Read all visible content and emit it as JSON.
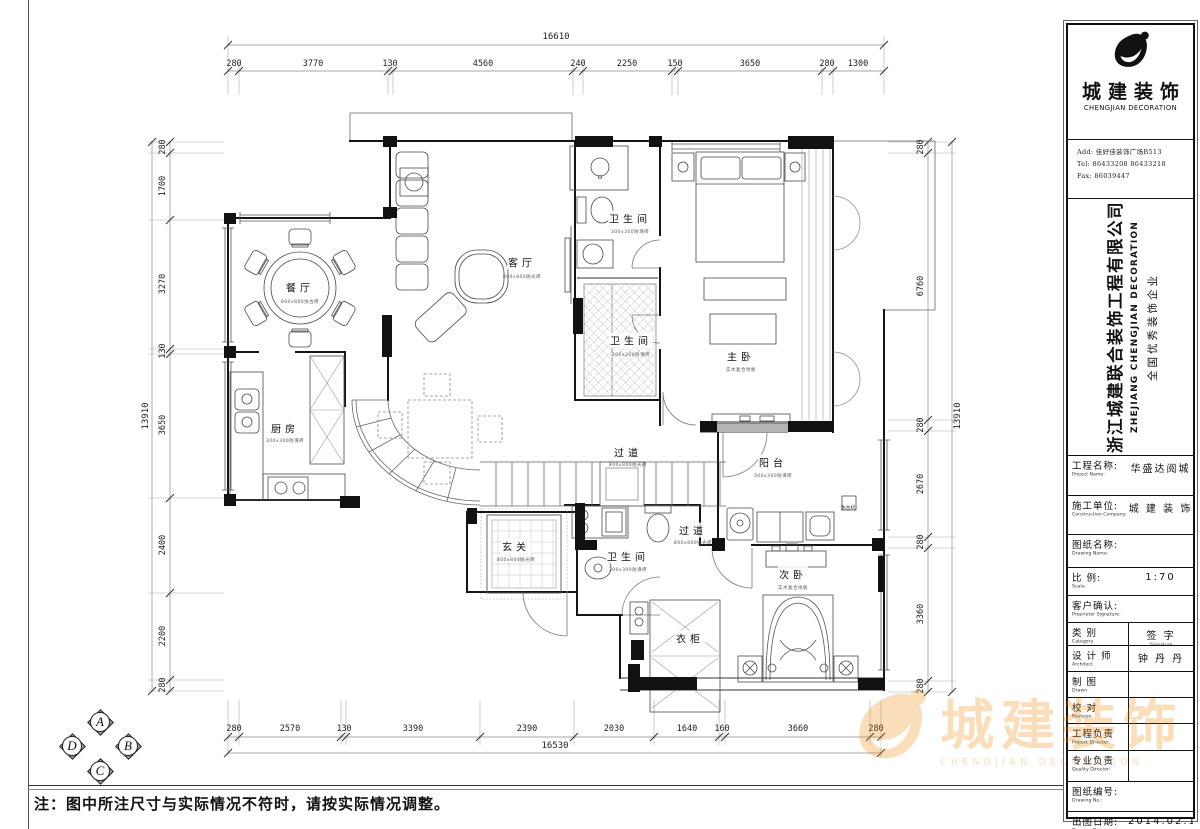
{
  "note": "注：图中所注尺寸与实际情况不符时，请按实际情况调整。",
  "logo": {
    "company_cn": "城建装饰",
    "company_en": "CHENGJIAN DECORATION",
    "address": "Add: 佳好佳装饰广场B513",
    "tel": "Tel: 86433208 86433218",
    "fax": "Fax: 86039447"
  },
  "watermark": {
    "cn": "城建装饰",
    "en": "CHENGJIAN DECORATION"
  },
  "sidebar": {
    "company_full": "浙江城建联合装饰工程有限公司",
    "company_full_en": "ZHEJIANG CHENGJIAN DECORATION",
    "slogan": "全国优秀装饰企业",
    "rows": [
      {
        "label": "工程名称:",
        "sub": "Project Name:",
        "value": "华盛达阅城",
        "h": 39
      },
      {
        "label": "施工单位:",
        "sub": "Construction Company:",
        "value": "城 建 装 饰",
        "h": 38
      },
      {
        "label": "图纸名称:",
        "sub": "Drawing Name:",
        "value": "",
        "h": 32
      },
      {
        "label": "比 例:",
        "sub": "Scale:",
        "value": "1:70",
        "h": 27
      },
      {
        "label": "客户确认:",
        "sub": "Proprietor Signature:",
        "value": "",
        "h": 26
      },
      {
        "label": "类 别",
        "sub": "Category",
        "value": "签 字",
        "vsub": "Signature",
        "h": 22,
        "split": true
      },
      {
        "label": "设 计 师",
        "sub": "Architect",
        "value": "钟 丹 丹",
        "h": 25,
        "split": true
      },
      {
        "label": "制 图",
        "sub": "Drawn",
        "value": "",
        "h": 25,
        "split": true
      },
      {
        "label": "校 对",
        "sub": "Revision",
        "value": "",
        "h": 25,
        "split": true
      },
      {
        "label": "工程负责",
        "sub": "Project Director:",
        "value": "",
        "h": 26,
        "split": true
      },
      {
        "label": "专业负责",
        "sub": "Quality Director:",
        "value": "",
        "h": 30,
        "split": true
      },
      {
        "label": "图纸编号:",
        "sub": "Drawing No.:",
        "value": "",
        "h": 29
      },
      {
        "label": "出图日期:",
        "sub": "Drawing Date:",
        "value": "2014.02.13",
        "h": 26
      }
    ]
  },
  "compass": {
    "items": [
      {
        "t": "A",
        "x": 100,
        "y": 722
      },
      {
        "t": "B",
        "x": 128,
        "y": 746
      },
      {
        "t": "C",
        "x": 100,
        "y": 771
      },
      {
        "t": "D",
        "x": 72,
        "y": 746
      }
    ]
  },
  "plan": {
    "labels": [
      {
        "t": "16610",
        "x": 556,
        "y": 37,
        "cls": "total"
      },
      {
        "t": "280",
        "x": 234,
        "y": 64,
        "cls": "dim"
      },
      {
        "t": "3770",
        "x": 313,
        "y": 64,
        "cls": "dim"
      },
      {
        "t": "130",
        "x": 390,
        "y": 64,
        "cls": "dim"
      },
      {
        "t": "4560",
        "x": 483,
        "y": 64,
        "cls": "dim"
      },
      {
        "t": "240",
        "x": 578,
        "y": 64,
        "cls": "dim"
      },
      {
        "t": "2250",
        "x": 627,
        "y": 64,
        "cls": "dim"
      },
      {
        "t": "150",
        "x": 675,
        "y": 64,
        "cls": "dim"
      },
      {
        "t": "3650",
        "x": 750,
        "y": 64,
        "cls": "dim"
      },
      {
        "t": "280",
        "x": 827,
        "y": 64,
        "cls": "dim"
      },
      {
        "t": "1300",
        "x": 858,
        "y": 64,
        "cls": "dim"
      },
      {
        "t": "280",
        "x": 234,
        "y": 729,
        "cls": "dim"
      },
      {
        "t": "2570",
        "x": 290,
        "y": 729,
        "cls": "dim"
      },
      {
        "t": "130",
        "x": 344,
        "y": 729,
        "cls": "dim"
      },
      {
        "t": "3390",
        "x": 413,
        "y": 729,
        "cls": "dim"
      },
      {
        "t": "2390",
        "x": 527,
        "y": 729,
        "cls": "dim"
      },
      {
        "t": "2030",
        "x": 614,
        "y": 729,
        "cls": "dim"
      },
      {
        "t": "1640",
        "x": 687,
        "y": 729,
        "cls": "dim"
      },
      {
        "t": "160",
        "x": 722,
        "y": 729,
        "cls": "dim"
      },
      {
        "t": "3660",
        "x": 798,
        "y": 729,
        "cls": "dim"
      },
      {
        "t": "280",
        "x": 876,
        "y": 729,
        "cls": "dim"
      },
      {
        "t": "16530",
        "x": 555,
        "y": 746,
        "cls": "total"
      },
      {
        "t": "280",
        "x": 163,
        "y": 147,
        "cls": "dim",
        "rot": -90
      },
      {
        "t": "1700",
        "x": 163,
        "y": 186,
        "cls": "dim",
        "rot": -90
      },
      {
        "t": "3270",
        "x": 163,
        "y": 284,
        "cls": "dim",
        "rot": -90
      },
      {
        "t": "130",
        "x": 163,
        "y": 351,
        "cls": "dim",
        "rot": -90
      },
      {
        "t": "3650",
        "x": 163,
        "y": 425,
        "cls": "dim",
        "rot": -90
      },
      {
        "t": "2400",
        "x": 163,
        "y": 545,
        "cls": "dim",
        "rot": -90
      },
      {
        "t": "2200",
        "x": 163,
        "y": 636,
        "cls": "dim",
        "rot": -90
      },
      {
        "t": "280",
        "x": 163,
        "y": 685,
        "cls": "dim",
        "rot": -90
      },
      {
        "t": "13910",
        "x": 146,
        "y": 416,
        "cls": "total",
        "rot": -90
      },
      {
        "t": "280",
        "x": 921,
        "y": 147,
        "cls": "dim",
        "rot": -90
      },
      {
        "t": "6760",
        "x": 921,
        "y": 286,
        "cls": "dim",
        "rot": -90
      },
      {
        "t": "280",
        "x": 921,
        "y": 425,
        "cls": "dim",
        "rot": -90
      },
      {
        "t": "2670",
        "x": 921,
        "y": 484,
        "cls": "dim",
        "rot": -90
      },
      {
        "t": "280",
        "x": 921,
        "y": 542,
        "cls": "dim",
        "rot": -90
      },
      {
        "t": "3360",
        "x": 921,
        "y": 614,
        "cls": "dim",
        "rot": -90
      },
      {
        "t": "280",
        "x": 921,
        "y": 686,
        "cls": "dim",
        "rot": -90
      },
      {
        "t": "13910",
        "x": 958,
        "y": 416,
        "cls": "total",
        "rot": -90
      },
      {
        "t": "餐厅",
        "x": 300,
        "y": 287,
        "cls": "room"
      },
      {
        "t": "800x800仿古砖",
        "x": 300,
        "y": 302,
        "cls": "sub"
      },
      {
        "t": "客厅",
        "x": 522,
        "y": 262,
        "cls": "room"
      },
      {
        "t": "800x800抛光砖",
        "x": 522,
        "y": 277,
        "cls": "sub"
      },
      {
        "t": "卫生间",
        "x": 630,
        "y": 218,
        "cls": "room"
      },
      {
        "t": "300x300防滑砖",
        "x": 630,
        "y": 232,
        "cls": "sub"
      },
      {
        "t": "卫生间",
        "x": 631,
        "y": 340,
        "cls": "room"
      },
      {
        "t": "300x300防滑砖",
        "x": 631,
        "y": 355,
        "cls": "sub"
      },
      {
        "t": "主卧",
        "x": 741,
        "y": 356,
        "cls": "room"
      },
      {
        "t": "实木复合地板",
        "x": 741,
        "y": 370,
        "cls": "sub"
      },
      {
        "t": "厨房",
        "x": 285,
        "y": 428,
        "cls": "room"
      },
      {
        "t": "300x300防滑砖",
        "x": 285,
        "y": 441,
        "cls": "sub"
      },
      {
        "t": "过道",
        "x": 628,
        "y": 452,
        "cls": "room"
      },
      {
        "t": "800x800抛光砖",
        "x": 628,
        "y": 465,
        "cls": "sub"
      },
      {
        "t": "阳台",
        "x": 773,
        "y": 462,
        "cls": "room"
      },
      {
        "t": "300x300防滑砖",
        "x": 773,
        "y": 476,
        "cls": "sub"
      },
      {
        "t": "过道",
        "x": 693,
        "y": 530,
        "cls": "room"
      },
      {
        "t": "800x800抛光砖",
        "x": 693,
        "y": 543,
        "cls": "sub"
      },
      {
        "t": "玄关",
        "x": 516,
        "y": 546,
        "cls": "room"
      },
      {
        "t": "800x800抛光砖",
        "x": 516,
        "y": 560,
        "cls": "sub"
      },
      {
        "t": "卫生间",
        "x": 628,
        "y": 556,
        "cls": "room"
      },
      {
        "t": "300x300防滑砖",
        "x": 628,
        "y": 570,
        "cls": "sub"
      },
      {
        "t": "次卧",
        "x": 793,
        "y": 574,
        "cls": "room"
      },
      {
        "t": "实木复合地板",
        "x": 793,
        "y": 588,
        "cls": "sub"
      },
      {
        "t": "衣柜",
        "x": 690,
        "y": 638,
        "cls": "room"
      },
      {
        "t": "洗衣机",
        "x": 848,
        "y": 508,
        "cls": "tiny"
      }
    ]
  }
}
